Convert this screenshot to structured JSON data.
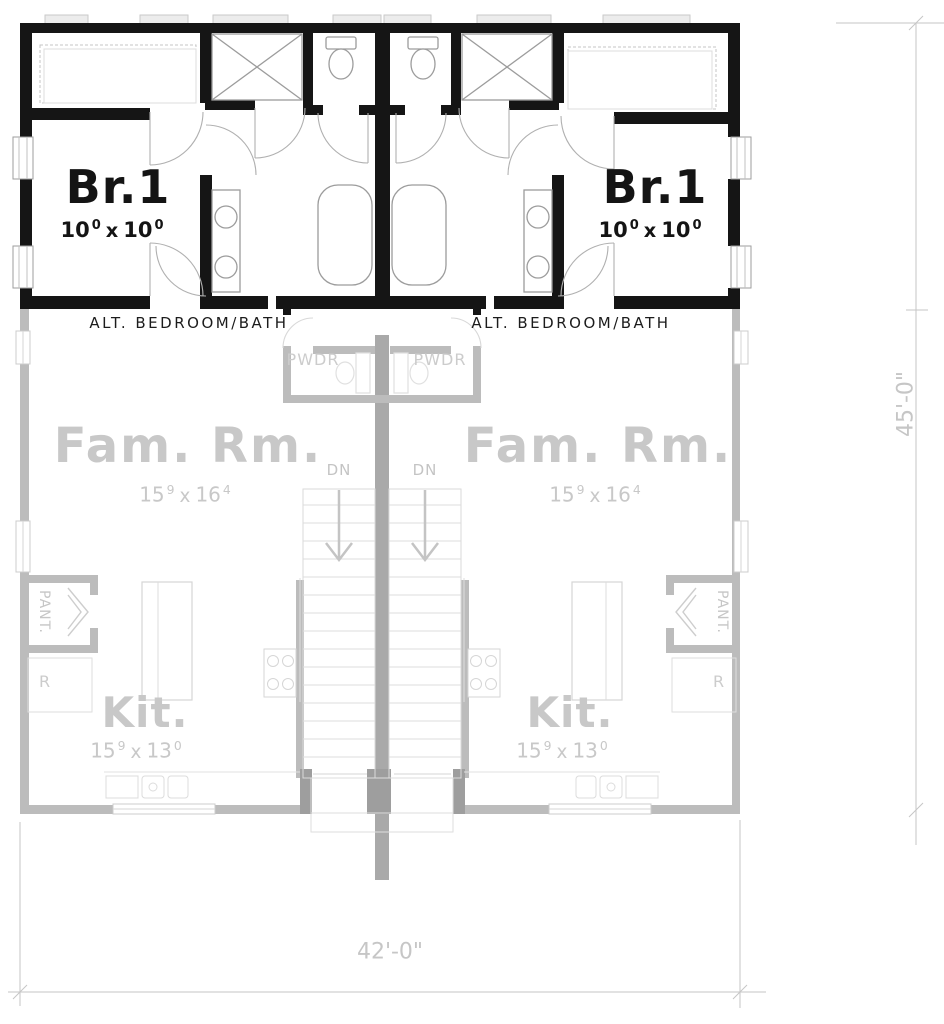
{
  "colors": {
    "wall_active": "#151515",
    "wall_faded": "#bcbcbc",
    "wall_center": "#a9a9a9",
    "label_faded": "#c8c8c8",
    "dimension_lines": "#c6c6c6",
    "fixture_lines": "#9c9c9c"
  },
  "upper_floor": {
    "left_unit": {
      "room_name": "Br.1",
      "dim_ft_a": "10",
      "dim_in_a": "0",
      "dim_sep": "x",
      "dim_ft_b": "10",
      "dim_in_b": "0",
      "caption": "ALT. BEDROOM/BATH"
    },
    "right_unit": {
      "room_name": "Br.1",
      "dim_ft_a": "10",
      "dim_in_a": "0",
      "dim_sep": "x",
      "dim_ft_b": "10",
      "dim_in_b": "0",
      "caption": "ALT. BEDROOM/BATH"
    }
  },
  "lower_floor": {
    "powder_left": {
      "label": "PWDR"
    },
    "powder_right": {
      "label": "PWDR"
    },
    "family_left": {
      "room_name": "Fam. Rm.",
      "dim_ft_a": "15",
      "dim_in_a": "9",
      "dim_sep": "x",
      "dim_ft_b": "16",
      "dim_in_b": "4"
    },
    "family_right": {
      "room_name": "Fam. Rm.",
      "dim_ft_a": "15",
      "dim_in_a": "9",
      "dim_sep": "x",
      "dim_ft_b": "16",
      "dim_in_b": "4"
    },
    "stairs_left": {
      "label": "DN"
    },
    "stairs_right": {
      "label": "DN"
    },
    "kitchen_left": {
      "room_name": "Kit.",
      "dim_ft_a": "15",
      "dim_in_a": "9",
      "dim_sep": "x",
      "dim_ft_b": "13",
      "dim_in_b": "0"
    },
    "kitchen_right": {
      "room_name": "Kit.",
      "dim_ft_a": "15",
      "dim_in_a": "9",
      "dim_sep": "x",
      "dim_ft_b": "13",
      "dim_in_b": "0"
    },
    "pantry_left": {
      "label": "PANT."
    },
    "pantry_right": {
      "label": "PANT."
    },
    "refrigerator_left": {
      "label": "R"
    },
    "refrigerator_right": {
      "label": "R"
    }
  },
  "dimensions": {
    "overall_width": "42'-0\"",
    "overall_depth": "45'-0\""
  }
}
